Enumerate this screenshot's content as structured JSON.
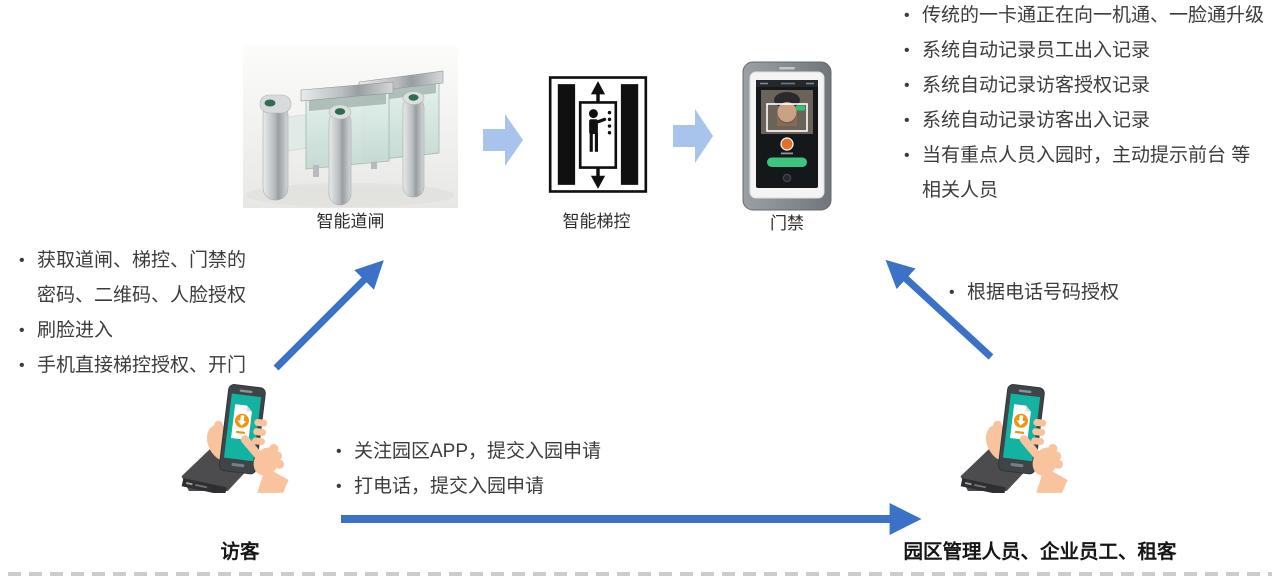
{
  "devices": {
    "gate": {
      "label": "智能道闸"
    },
    "elevator": {
      "label": "智能梯控"
    },
    "door": {
      "label": "门禁"
    }
  },
  "benefit_notes": [
    "传统的一卡通正在向一机通、一脸通升级",
    "系统自动记录员工出入记录",
    "系统自动记录访客授权记录",
    "系统自动记录访客出入记录",
    "当有重点人员入园时，主动提示前台 等相关人员"
  ],
  "visitor_notes": [
    "获取道闸、梯控、门禁的密码、二维码、人脸授权",
    "刷脸进入",
    "手机直接梯控授权、开门"
  ],
  "apply_notes": [
    "关注园区APP，提交入园申请",
    "打电话，提交入园申请"
  ],
  "authorize_notes": [
    "根据电话号码授权"
  ],
  "actors": {
    "visitor": "访客",
    "staff": "园区管理人员、企业员工、租客"
  },
  "colors": {
    "arrow_blue": "#3B72C7",
    "arrow_light_blue": "#A9C4EC",
    "text": "#3C3C3C"
  }
}
